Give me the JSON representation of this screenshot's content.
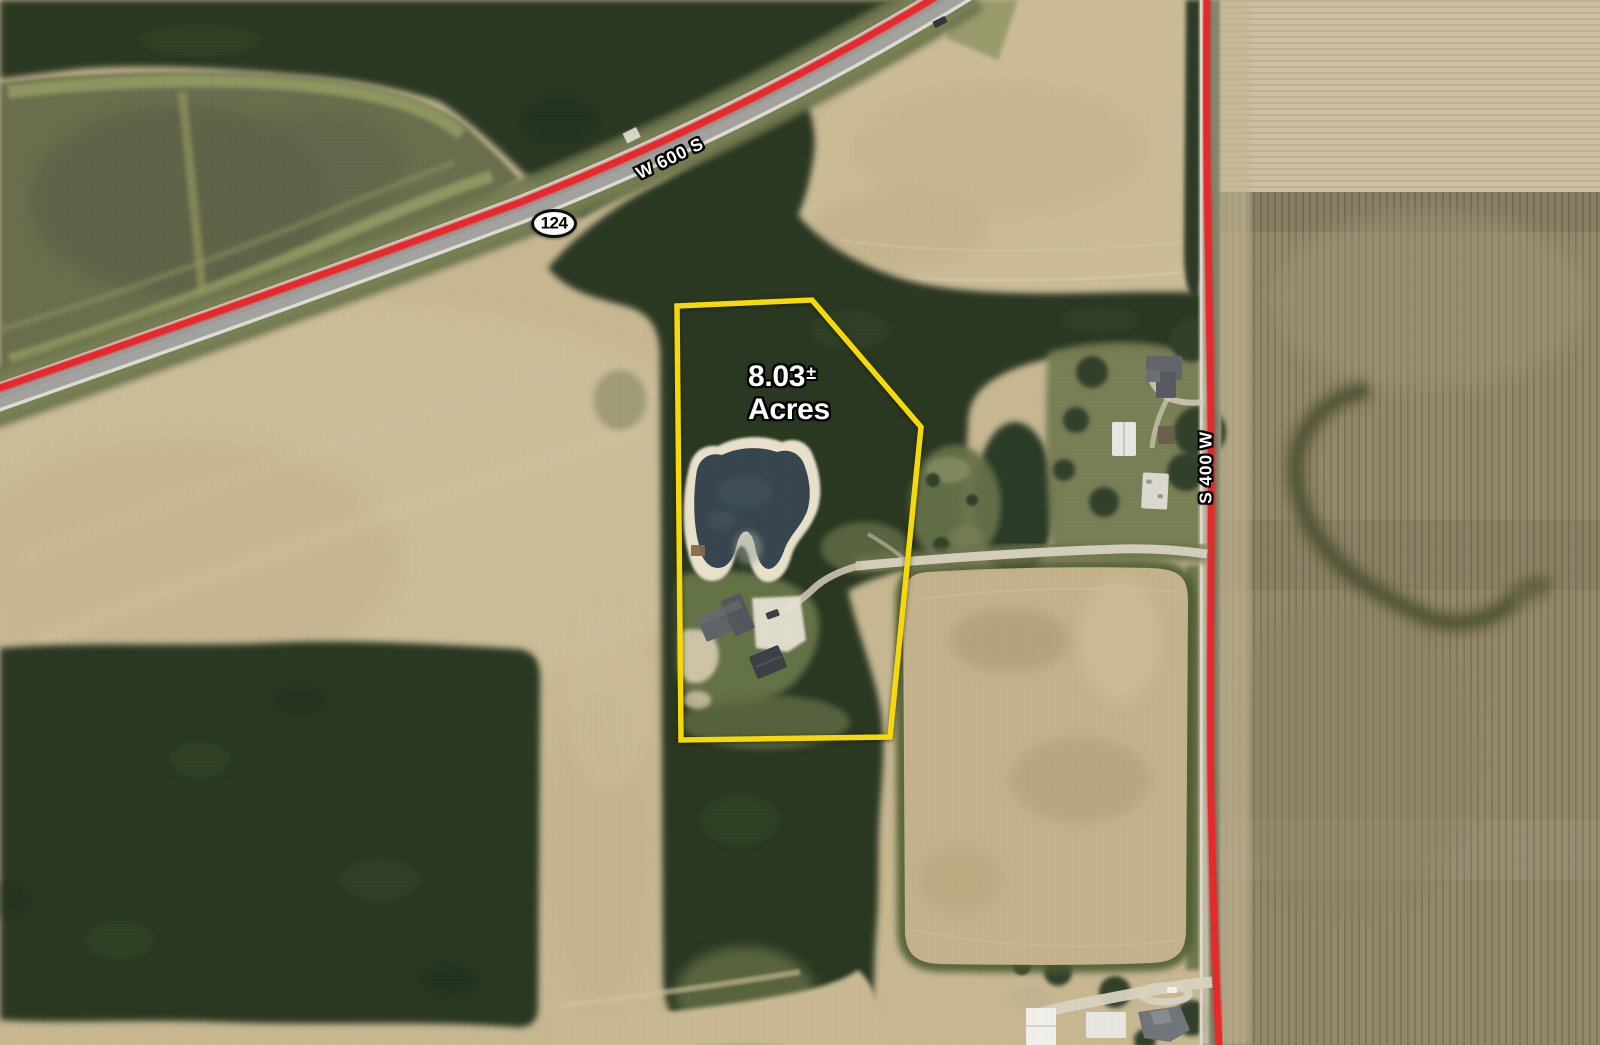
{
  "map": {
    "parcel": {
      "acreage_value": "8.03",
      "acreage_tolerance": "±",
      "acreage_unit": "Acres",
      "boundary_color": "#F6DA08"
    },
    "roads": [
      {
        "name": "W 600 S",
        "orientation": "diagonal-northeast",
        "highlight_color": "#E9282B"
      },
      {
        "name": "S 400 W",
        "orientation": "vertical",
        "highlight_color": "#E9282B"
      }
    ],
    "route_shield": {
      "number": "124",
      "shape": "oval",
      "fill": "#FFFFFF",
      "border": "#0E0E0E"
    }
  }
}
